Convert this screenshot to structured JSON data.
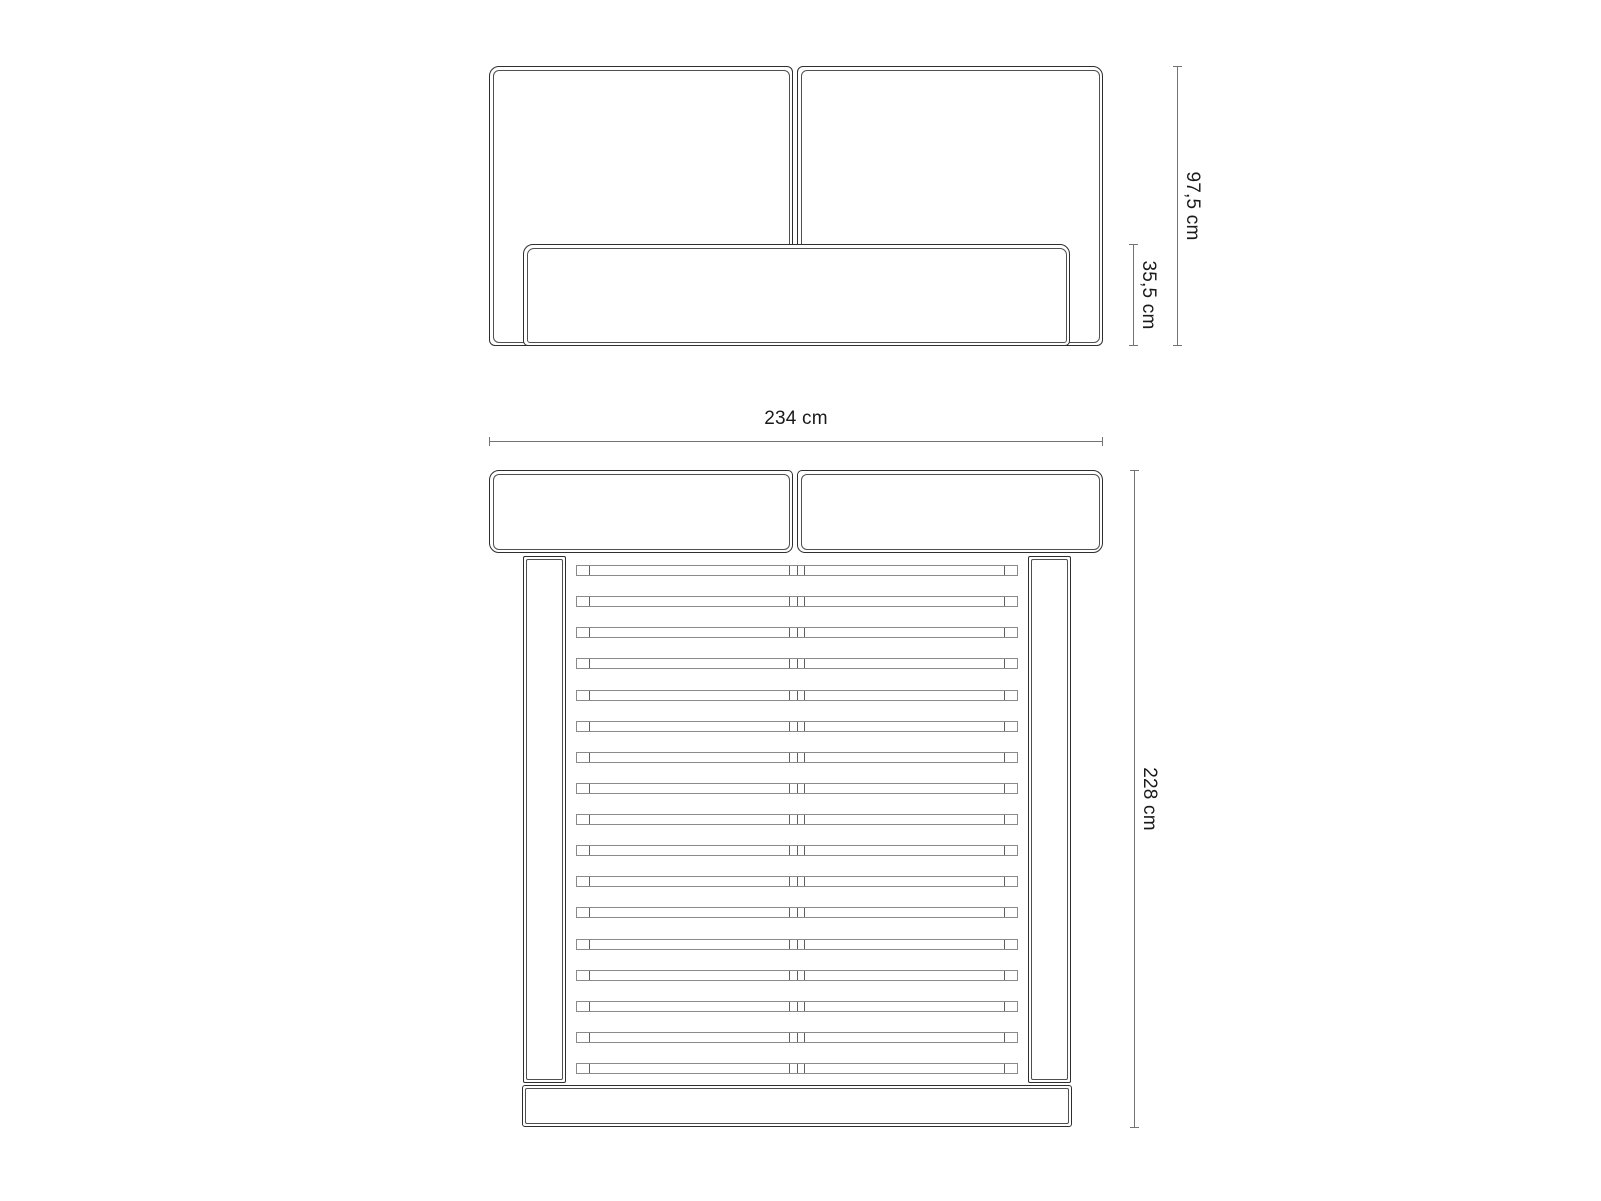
{
  "drawing": {
    "title": "bed-dimension-drawing",
    "colors": {
      "background": "#ffffff",
      "line": "#2e2e2e",
      "inner_line": "#4f4f4f",
      "slat_line": "#8a8a8a",
      "dimension_line": "#737373",
      "text": "#1a1a1a"
    },
    "front_view": {
      "height_total_label": "97,5 cm",
      "height_box_label": "35,5 cm"
    },
    "top_view": {
      "width_label": "234 cm",
      "depth_label": "228 cm",
      "slat_count": 17
    }
  }
}
